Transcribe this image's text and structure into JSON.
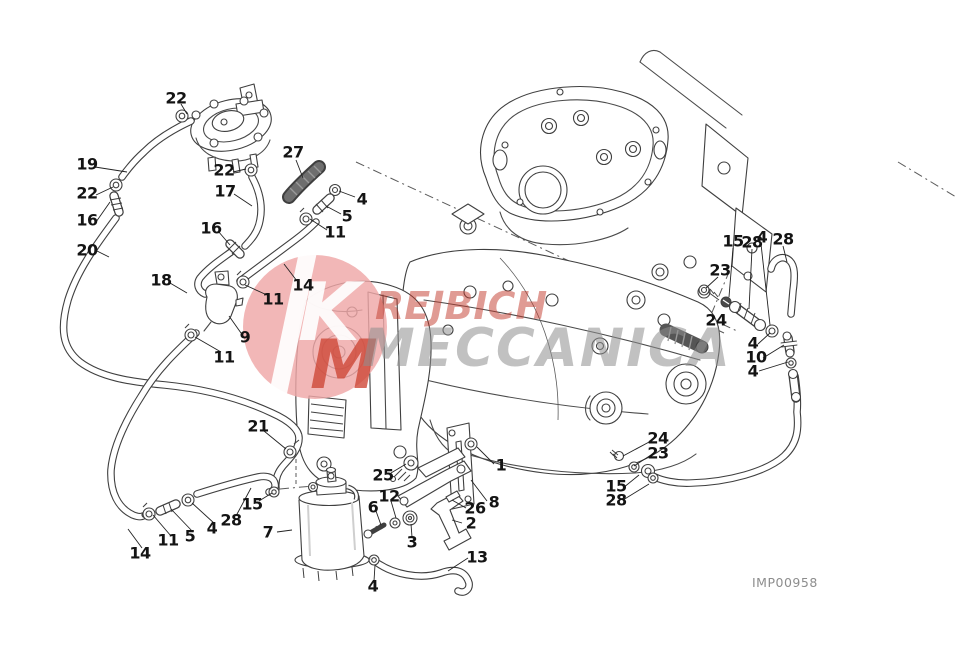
{
  "figure_code": "IMP00958",
  "watermark": {
    "monogram_top": "K",
    "monogram_bottom": "M",
    "brand_line1": "REJBICH",
    "brand_line2": "MECCANICA",
    "circle_color": "#efa7a7",
    "monogram_color": "#cf4838",
    "line1_color": "#c23a2c",
    "line2_color": "#8f8f8f"
  },
  "callouts": [
    {
      "label": "22",
      "x": 176,
      "y": 99
    },
    {
      "label": "19",
      "x": 87,
      "y": 165
    },
    {
      "label": "22",
      "x": 87,
      "y": 194
    },
    {
      "label": "16",
      "x": 87,
      "y": 221
    },
    {
      "label": "20",
      "x": 87,
      "y": 251
    },
    {
      "label": "22",
      "x": 224,
      "y": 171
    },
    {
      "label": "17",
      "x": 225,
      "y": 192
    },
    {
      "label": "16",
      "x": 211,
      "y": 229
    },
    {
      "label": "18",
      "x": 161,
      "y": 281
    },
    {
      "label": "27",
      "x": 293,
      "y": 153
    },
    {
      "label": "4",
      "x": 362,
      "y": 200
    },
    {
      "label": "5",
      "x": 347,
      "y": 217
    },
    {
      "label": "11",
      "x": 335,
      "y": 233
    },
    {
      "label": "14",
      "x": 303,
      "y": 286
    },
    {
      "label": "11",
      "x": 273,
      "y": 300
    },
    {
      "label": "9",
      "x": 245,
      "y": 338
    },
    {
      "label": "11",
      "x": 224,
      "y": 358
    },
    {
      "label": "21",
      "x": 258,
      "y": 427
    },
    {
      "label": "15",
      "x": 252,
      "y": 505
    },
    {
      "label": "28",
      "x": 231,
      "y": 521
    },
    {
      "label": "4",
      "x": 212,
      "y": 529
    },
    {
      "label": "5",
      "x": 190,
      "y": 537
    },
    {
      "label": "11",
      "x": 168,
      "y": 541
    },
    {
      "label": "14",
      "x": 140,
      "y": 554
    },
    {
      "label": "7",
      "x": 268,
      "y": 533
    },
    {
      "label": "25",
      "x": 383,
      "y": 476
    },
    {
      "label": "12",
      "x": 389,
      "y": 497
    },
    {
      "label": "6",
      "x": 373,
      "y": 508
    },
    {
      "label": "3",
      "x": 412,
      "y": 543
    },
    {
      "label": "26",
      "x": 475,
      "y": 509
    },
    {
      "label": "2",
      "x": 471,
      "y": 524
    },
    {
      "label": "13",
      "x": 477,
      "y": 558
    },
    {
      "label": "4",
      "x": 373,
      "y": 587
    },
    {
      "label": "1",
      "x": 501,
      "y": 466
    },
    {
      "label": "8",
      "x": 494,
      "y": 503
    },
    {
      "label": "15",
      "x": 733,
      "y": 242
    },
    {
      "label": "28",
      "x": 752,
      "y": 243
    },
    {
      "label": "4",
      "x": 762,
      "y": 238
    },
    {
      "label": "28",
      "x": 783,
      "y": 240
    },
    {
      "label": "23",
      "x": 720,
      "y": 271
    },
    {
      "label": "24",
      "x": 716,
      "y": 321
    },
    {
      "label": "4",
      "x": 753,
      "y": 344
    },
    {
      "label": "10",
      "x": 756,
      "y": 358
    },
    {
      "label": "4",
      "x": 753,
      "y": 372
    },
    {
      "label": "24",
      "x": 658,
      "y": 439
    },
    {
      "label": "23",
      "x": 658,
      "y": 454
    },
    {
      "label": "15",
      "x": 616,
      "y": 487
    },
    {
      "label": "28",
      "x": 616,
      "y": 501
    }
  ]
}
